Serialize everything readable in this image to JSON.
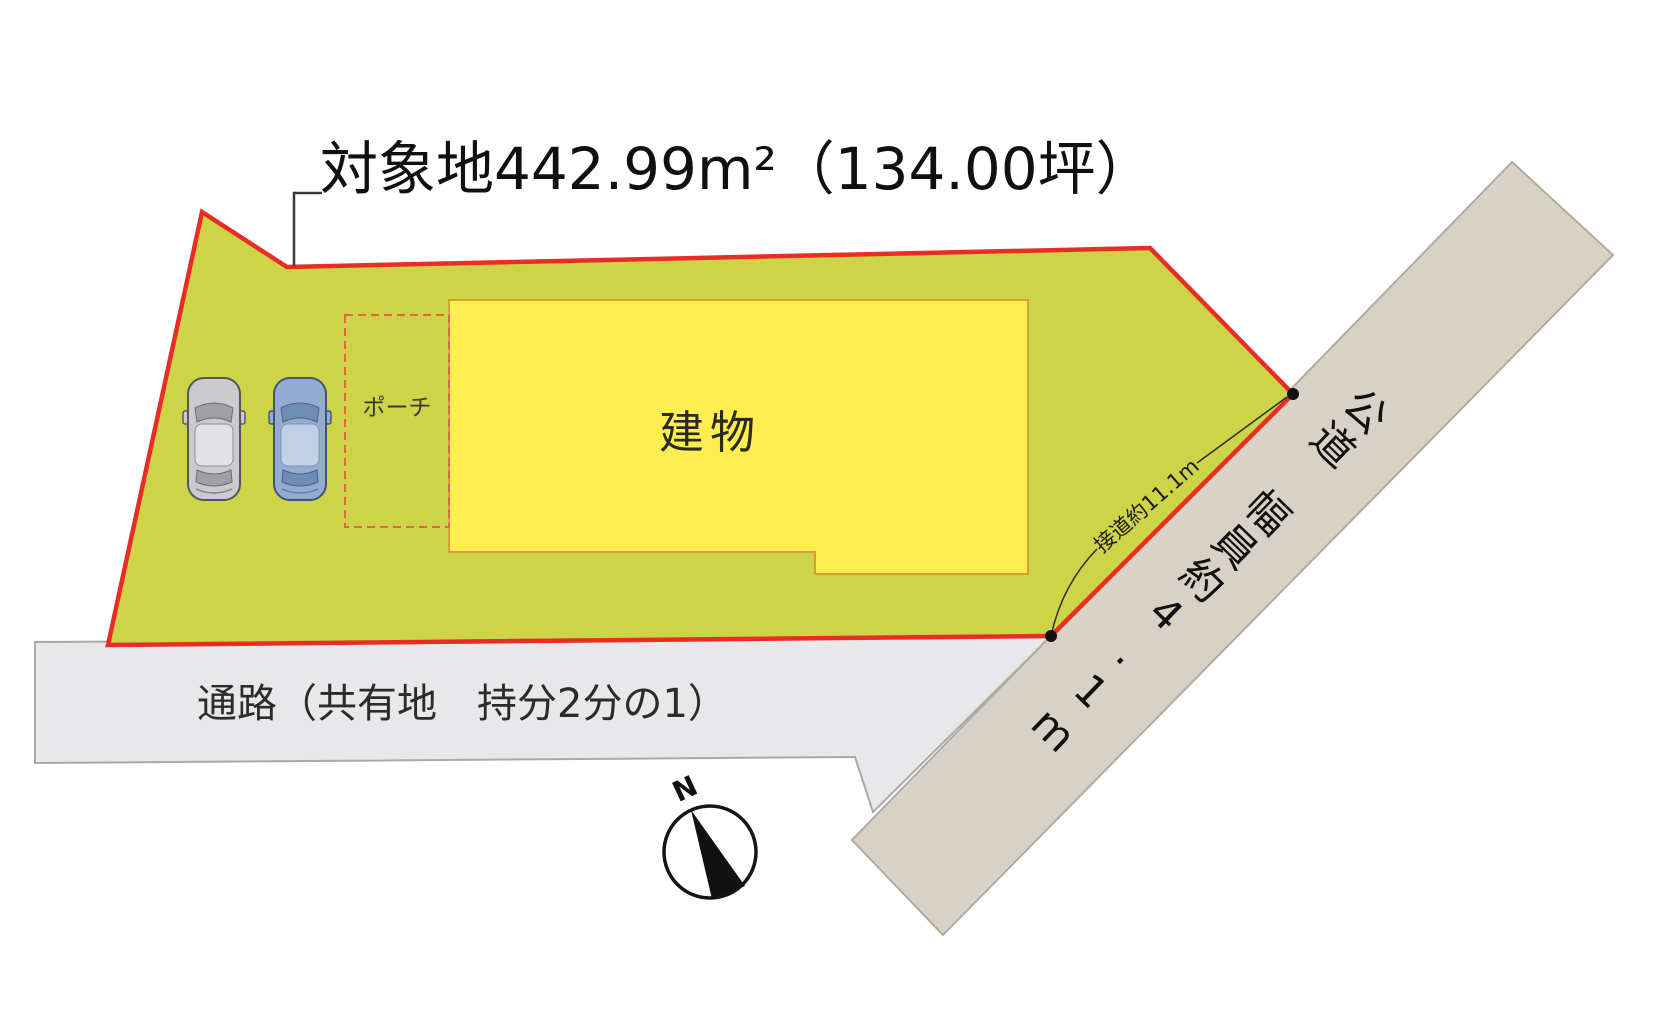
{
  "title": "対象地442.99m²（134.00坪）",
  "site": {
    "building_label": "建物",
    "porch_label": "ポーチ"
  },
  "passage": {
    "label": "通路（共有地　持分2分の1）"
  },
  "road": {
    "label": "公道　幅員約4.1m",
    "frontage_label": "接道約11.1m"
  },
  "compass": {
    "north_label": "N"
  },
  "colors": {
    "lot_fill": "#cdd448",
    "lot_border": "#e82d26",
    "building_fill": "#ffee4e",
    "building_border": "#dd9c33",
    "porch_border": "#e06648",
    "road_fill": "#d8d1c5",
    "road_border": "#b4aa9c",
    "passage_fill": "#e8e8ea",
    "passage_border": "#a9a9ab",
    "leader_line": "#3a3a3a",
    "dimension_line": "#2b2b2b",
    "car_gray": "#cbcbcd",
    "car_blue": "#93accf"
  }
}
